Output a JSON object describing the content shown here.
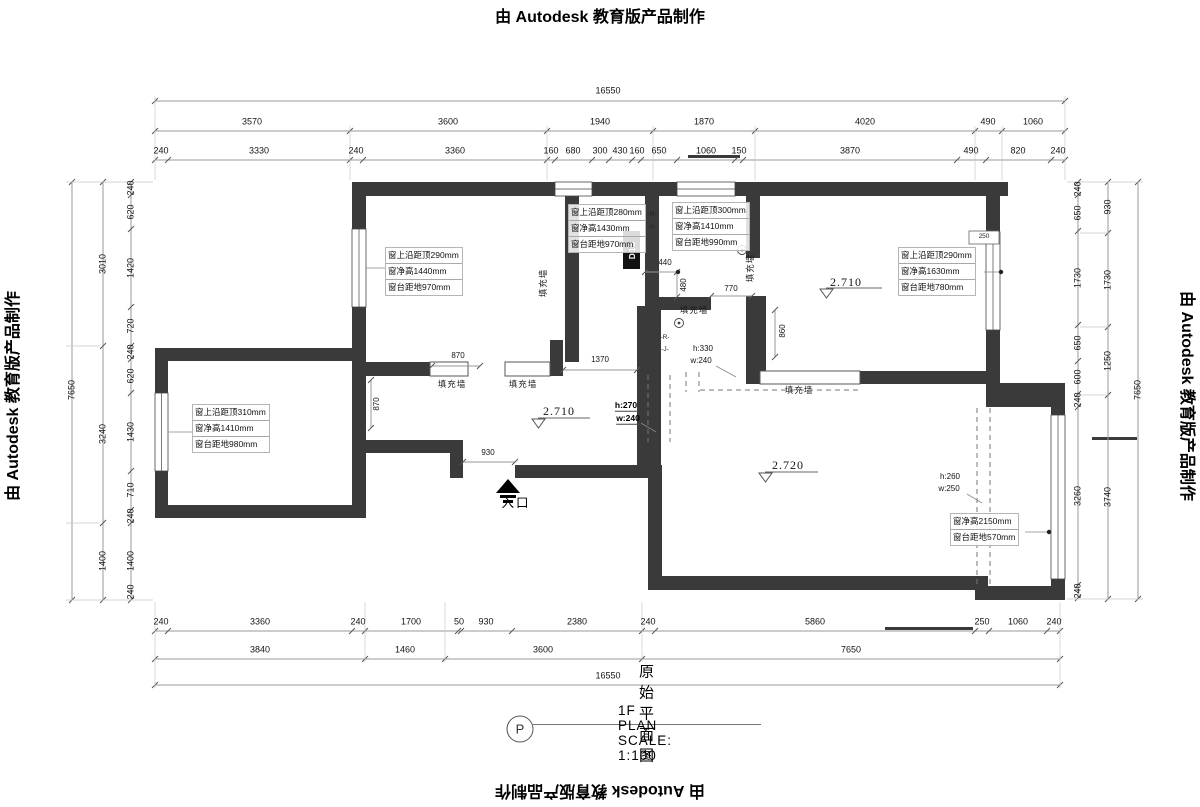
{
  "watermark_text": "由 Autodesk 教育版产品制作",
  "title_block": {
    "symbol": "P",
    "title": "原始平面图",
    "scale_label": "1F PLAN SCALE: 1:100"
  },
  "colors": {
    "wall": "#3a3a3a",
    "dim_line": "#9a9a9a",
    "text": "#111111"
  },
  "window_annotations": [
    {
      "x": 385,
      "y": 247,
      "lines": [
        "窗上沿距顶290mm",
        "窗净高1440mm",
        "窗台距地970mm"
      ]
    },
    {
      "x": 568,
      "y": 204,
      "lines": [
        "窗上沿距顶280mm",
        "窗净高1430mm",
        "窗台距地970mm"
      ]
    },
    {
      "x": 672,
      "y": 202,
      "lines": [
        "窗上沿距顶300mm",
        "窗净高1410mm",
        "窗台距地990mm"
      ]
    },
    {
      "x": 898,
      "y": 247,
      "lines": [
        "窗上沿距顶290mm",
        "窗净高1630mm",
        "窗台距地780mm"
      ]
    },
    {
      "x": 192,
      "y": 404,
      "lines": [
        "窗上沿距顶310mm",
        "窗净高1410mm",
        "窗台距地980mm"
      ]
    },
    {
      "x": 950,
      "y": 513,
      "lines": [
        "窗净高2150mm",
        "窗台距地570mm"
      ]
    }
  ],
  "labels": [
    {
      "t": "16550",
      "x": 608,
      "y": 91
    },
    {
      "t": "3570",
      "x": 252,
      "y": 122
    },
    {
      "t": "3600",
      "x": 448,
      "y": 122
    },
    {
      "t": "1940",
      "x": 600,
      "y": 122
    },
    {
      "t": "1870",
      "x": 704,
      "y": 122
    },
    {
      "t": "4020",
      "x": 865,
      "y": 122
    },
    {
      "t": "490",
      "x": 988,
      "y": 122
    },
    {
      "t": "1060",
      "x": 1033,
      "y": 122
    },
    {
      "t": "240",
      "x": 161,
      "y": 151
    },
    {
      "t": "3330",
      "x": 259,
      "y": 151
    },
    {
      "t": "240",
      "x": 356,
      "y": 151
    },
    {
      "t": "3360",
      "x": 455,
      "y": 151
    },
    {
      "t": "160",
      "x": 551,
      "y": 151
    },
    {
      "t": "680",
      "x": 573,
      "y": 151
    },
    {
      "t": "300",
      "x": 600,
      "y": 151
    },
    {
      "t": "430",
      "x": 620,
      "y": 151
    },
    {
      "t": "160",
      "x": 637,
      "y": 151
    },
    {
      "t": "650",
      "x": 659,
      "y": 151
    },
    {
      "t": "1060",
      "x": 706,
      "y": 151
    },
    {
      "t": "150",
      "x": 739,
      "y": 151
    },
    {
      "t": "3870",
      "x": 850,
      "y": 151
    },
    {
      "t": "490",
      "x": 971,
      "y": 151
    },
    {
      "t": "820",
      "x": 1018,
      "y": 151
    },
    {
      "t": "240",
      "x": 1058,
      "y": 151
    },
    {
      "t": "240",
      "x": 161,
      "y": 622
    },
    {
      "t": "3360",
      "x": 260,
      "y": 622
    },
    {
      "t": "240",
      "x": 358,
      "y": 622
    },
    {
      "t": "1700",
      "x": 411,
      "y": 622
    },
    {
      "t": "50",
      "x": 459,
      "y": 622
    },
    {
      "t": "930",
      "x": 486,
      "y": 622
    },
    {
      "t": "2380",
      "x": 577,
      "y": 622
    },
    {
      "t": "240",
      "x": 648,
      "y": 622
    },
    {
      "t": "5860",
      "x": 815,
      "y": 622
    },
    {
      "t": "250",
      "x": 982,
      "y": 622
    },
    {
      "t": "1060",
      "x": 1018,
      "y": 622
    },
    {
      "t": "240",
      "x": 1054,
      "y": 622
    },
    {
      "t": "3840",
      "x": 260,
      "y": 650
    },
    {
      "t": "1460",
      "x": 405,
      "y": 650
    },
    {
      "t": "3600",
      "x": 543,
      "y": 650
    },
    {
      "t": "7650",
      "x": 851,
      "y": 650
    },
    {
      "t": "16550",
      "x": 608,
      "y": 676
    },
    {
      "t": "7650",
      "x": 72,
      "y": 390,
      "r": -90
    },
    {
      "t": "3010",
      "x": 103,
      "y": 264,
      "r": -90
    },
    {
      "t": "3240",
      "x": 103,
      "y": 434,
      "r": -90
    },
    {
      "t": "1400",
      "x": 103,
      "y": 561,
      "r": -90
    },
    {
      "t": "240",
      "x": 131,
      "y": 188,
      "r": -90
    },
    {
      "t": "620",
      "x": 131,
      "y": 212,
      "r": -90
    },
    {
      "t": "1420",
      "x": 131,
      "y": 268,
      "r": -90
    },
    {
      "t": "720",
      "x": 131,
      "y": 326,
      "r": -90
    },
    {
      "t": "240",
      "x": 131,
      "y": 352,
      "r": -90
    },
    {
      "t": "620",
      "x": 131,
      "y": 376,
      "r": -90
    },
    {
      "t": "1430",
      "x": 131,
      "y": 432,
      "r": -90
    },
    {
      "t": "710",
      "x": 131,
      "y": 490,
      "r": -90
    },
    {
      "t": "240",
      "x": 131,
      "y": 516,
      "r": -90
    },
    {
      "t": "1400",
      "x": 131,
      "y": 561,
      "r": -90
    },
    {
      "t": "240",
      "x": 131,
      "y": 592,
      "r": -90
    },
    {
      "t": "240",
      "x": 1078,
      "y": 189,
      "r": -90
    },
    {
      "t": "650",
      "x": 1078,
      "y": 213,
      "r": -90
    },
    {
      "t": "1730",
      "x": 1078,
      "y": 278,
      "r": -90
    },
    {
      "t": "650",
      "x": 1078,
      "y": 343,
      "r": -90
    },
    {
      "t": "600",
      "x": 1078,
      "y": 377,
      "r": -90
    },
    {
      "t": "240",
      "x": 1078,
      "y": 400,
      "r": -90
    },
    {
      "t": "3260",
      "x": 1078,
      "y": 496,
      "r": -90
    },
    {
      "t": "240",
      "x": 1078,
      "y": 591,
      "r": -90
    },
    {
      "t": "930",
      "x": 1108,
      "y": 207,
      "r": -90
    },
    {
      "t": "1730",
      "x": 1108,
      "y": 280,
      "r": -90
    },
    {
      "t": "1250",
      "x": 1108,
      "y": 361,
      "r": -90
    },
    {
      "t": "3740",
      "x": 1108,
      "y": 497,
      "r": -90
    },
    {
      "t": "7650",
      "x": 1138,
      "y": 390,
      "r": -90
    },
    {
      "t": "870",
      "x": 458,
      "y": 356,
      "c": "ds"
    },
    {
      "t": "1370",
      "x": 600,
      "y": 360,
      "c": "ds"
    },
    {
      "t": "930",
      "x": 488,
      "y": 453,
      "c": "ds"
    },
    {
      "t": "440",
      "x": 665,
      "y": 263,
      "c": "ds"
    },
    {
      "t": "480",
      "x": 684,
      "y": 285,
      "r": -90,
      "c": "ds"
    },
    {
      "t": "770",
      "x": 731,
      "y": 289,
      "c": "ds"
    },
    {
      "t": "860",
      "x": 783,
      "y": 331,
      "r": -90,
      "c": "ds"
    },
    {
      "t": "870",
      "x": 377,
      "y": 404,
      "r": -90,
      "c": "ds"
    },
    {
      "t": "250",
      "x": 984,
      "y": 237,
      "c": "xs"
    },
    {
      "t": "h:330",
      "x": 703,
      "y": 349,
      "c": "ds"
    },
    {
      "t": "w:240",
      "x": 701,
      "y": 361,
      "c": "ds"
    },
    {
      "t": "h:270",
      "x": 626,
      "y": 406,
      "c": "dsb"
    },
    {
      "t": "w:240",
      "x": 628,
      "y": 419,
      "c": "dsb"
    },
    {
      "t": "h:260",
      "x": 950,
      "y": 477,
      "c": "ds"
    },
    {
      "t": "w:250",
      "x": 949,
      "y": 489,
      "c": "ds"
    },
    {
      "t": "填充墙",
      "x": 543,
      "y": 283,
      "r": -90,
      "c": "cn",
      "n": "infill-wall-label"
    },
    {
      "t": "填充墙",
      "x": 750,
      "y": 268,
      "r": -90,
      "c": "cn",
      "n": "infill-wall-label"
    },
    {
      "t": "填充墙",
      "x": 694,
      "y": 310,
      "c": "cn",
      "n": "infill-wall-label"
    },
    {
      "t": "填充墙",
      "x": 452,
      "y": 384,
      "c": "cn",
      "n": "infill-wall-label"
    },
    {
      "t": "填充墙",
      "x": 523,
      "y": 384,
      "c": "cn",
      "n": "infill-wall-label"
    },
    {
      "t": "填充墙",
      "x": 799,
      "y": 390,
      "c": "cn",
      "n": "infill-wall-label"
    },
    {
      "t": "入口",
      "x": 516,
      "y": 503,
      "c": "cn2",
      "n": "entrance-label"
    },
    {
      "t": "D18",
      "x": 632,
      "y": 250,
      "r": -90,
      "c": "tag",
      "n": "door-tag"
    },
    {
      "t": "-R-",
      "x": 652,
      "y": 215,
      "c": "xs"
    },
    {
      "t": "-J-",
      "x": 652,
      "y": 227,
      "c": "xs"
    },
    {
      "t": "-R-",
      "x": 665,
      "y": 338,
      "c": "xs"
    },
    {
      "t": "-J-",
      "x": 665,
      "y": 350,
      "c": "xs"
    },
    {
      "t": "2.710",
      "x": 846,
      "y": 282,
      "c": "el",
      "n": "elevation-value"
    },
    {
      "t": "2.710",
      "x": 559,
      "y": 411,
      "c": "el",
      "n": "elevation-value"
    },
    {
      "t": "2.720",
      "x": 788,
      "y": 465,
      "c": "el",
      "n": "elevation-value"
    }
  ]
}
